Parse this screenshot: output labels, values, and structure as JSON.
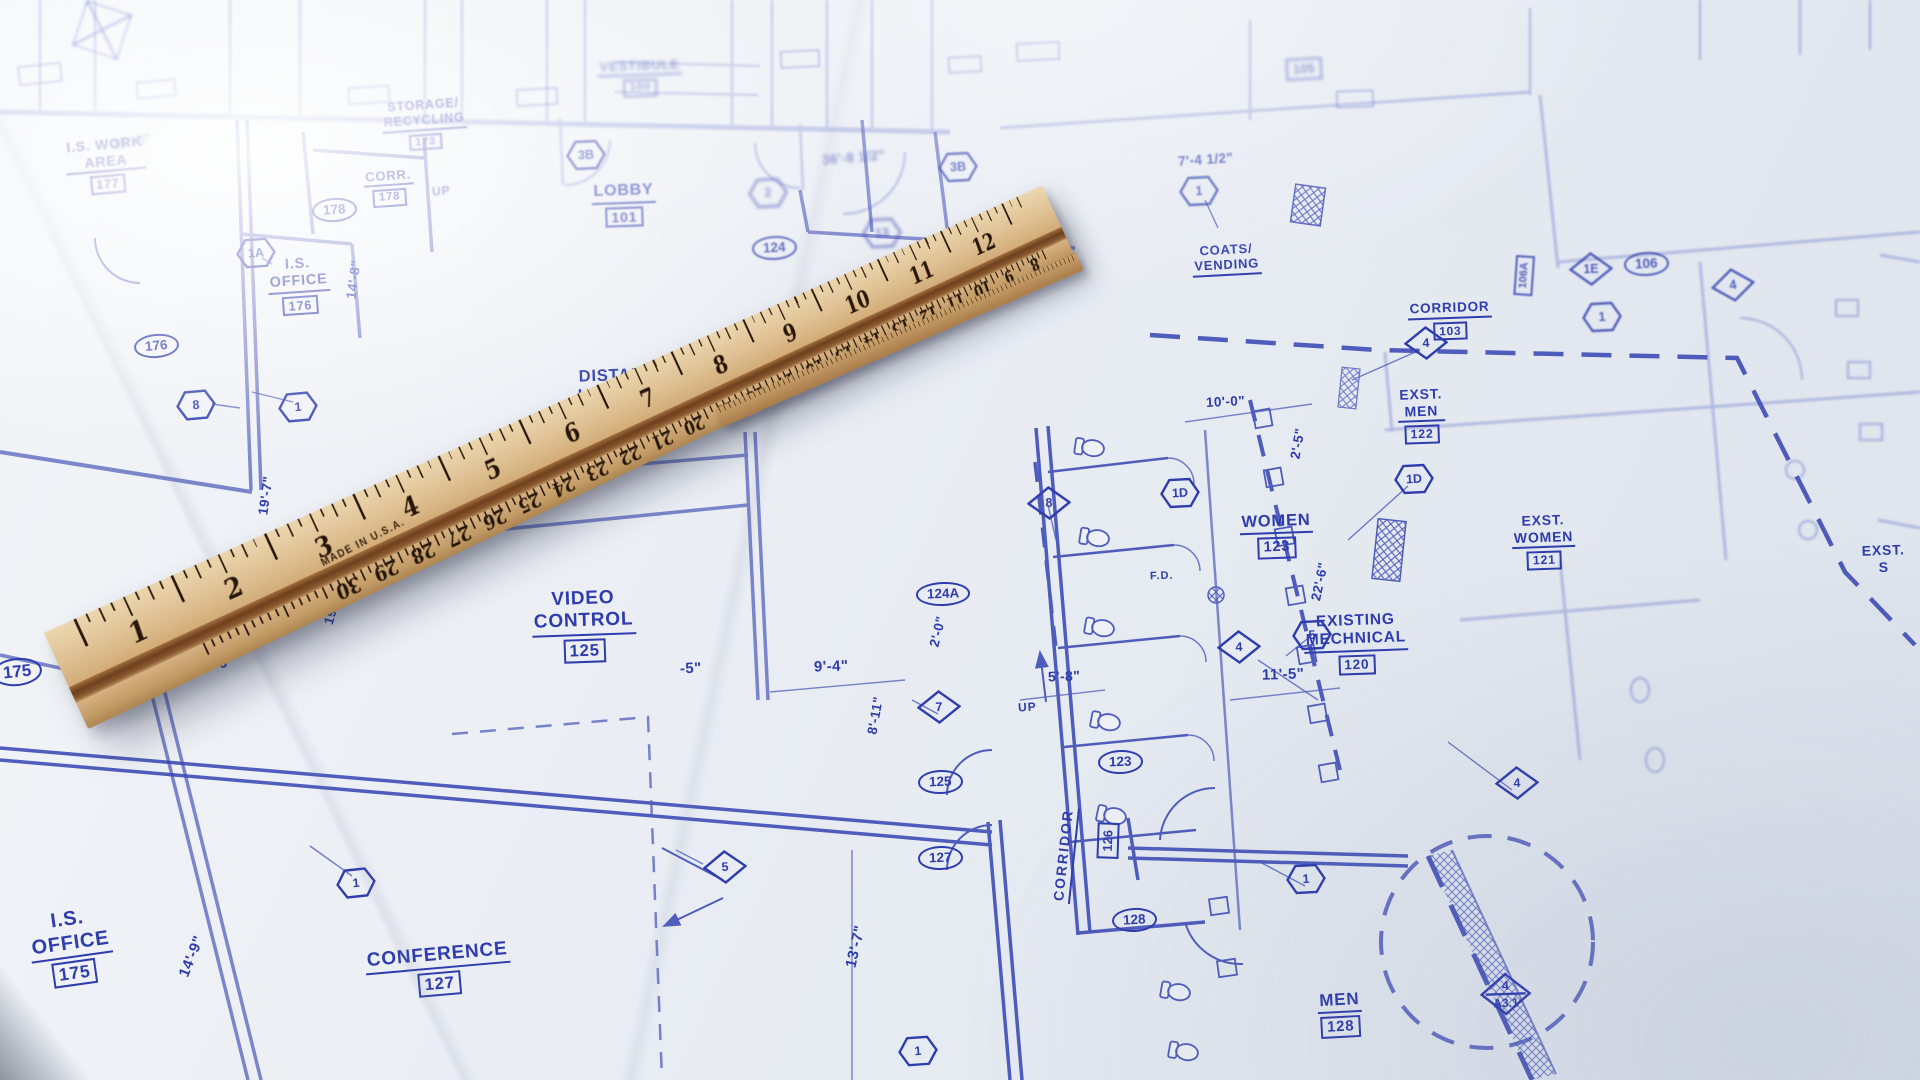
{
  "colors": {
    "ink": "#2e3cae",
    "ink_faint": "#6b78cc",
    "paper": "#e9edf3",
    "wood_light": "#e6cda0",
    "wood_dark": "#ad8551",
    "groove": "#6e3f1d"
  },
  "ruler": {
    "made_in": "MADE IN U.S.A.",
    "inch_numbers": [
      "1",
      "2",
      "3",
      "4",
      "5",
      "6",
      "7",
      "8",
      "9",
      "10",
      "11",
      "12"
    ],
    "cm_numbers": [
      "30",
      "29",
      "28",
      "27",
      "26",
      "25",
      "24",
      "23",
      "22",
      "21",
      "20",
      "19",
      "18",
      "17",
      "16",
      "15",
      "14",
      "13",
      "12",
      "11",
      "10",
      "9",
      "8"
    ]
  },
  "rooms": {
    "work_area": {
      "l1": "I.S. WORK",
      "l2": "AREA",
      "num": "177"
    },
    "storage": {
      "l1": "STORAGE/",
      "l2": "RECYCLING",
      "num": "173"
    },
    "corr": {
      "l1": "CORR.",
      "num": "178"
    },
    "office176": {
      "l1": "I.S.",
      "l2": "OFFICE",
      "num": "176"
    },
    "vestibule": {
      "l1": "VESTIBULE",
      "num": "100"
    },
    "lobby": {
      "l1": "LOBBY",
      "num": "101"
    },
    "distance": {
      "l1": "DISTANCE",
      "l2": "LEARNING",
      "num": "124"
    },
    "video": {
      "l1": "VIDEO",
      "l2": "CONTROL",
      "num": "125"
    },
    "conference": {
      "l1": "CONFERENCE",
      "num": "127"
    },
    "office175": {
      "l1": "I.S.",
      "l2": "OFFICE",
      "num": "175"
    },
    "women": {
      "l1": "WOMEN",
      "num": "123"
    },
    "men": {
      "l1": "MEN",
      "num": "128"
    },
    "corridor126": {
      "l1": "CORRIDOR",
      "num": "126"
    },
    "corridor103": {
      "l1": "CORRIDOR",
      "num": "103"
    },
    "exst_men": {
      "l1": "EXST.",
      "l2": "MEN",
      "num": "122"
    },
    "exst_women": {
      "l1": "EXST.",
      "l2": "WOMEN",
      "num": "121"
    },
    "mechanical": {
      "l1": "EXISTING",
      "l2": "MECHNICAL",
      "num": "120"
    },
    "coats": {
      "l1": "COATS/",
      "l2": "VENDING"
    },
    "exst_s": {
      "l1": "EXST.",
      "l2": "S"
    }
  },
  "dims": {
    "d30_8": "30'-8\"",
    "d36_8": "36'-8 1/2\"",
    "d7_4": "7'-4 1/2\"",
    "d10_0": "10'-0\"",
    "d2_5": "2'-5\"",
    "d22_6": "22'-6\"",
    "d11_5": "11'-5\"",
    "d5_8": "5'-8\"",
    "d2_0": "2'-0\"",
    "d9_4": "9'-4\"",
    "d8_11": "8'-11\"",
    "d13_7": "13'-7\"",
    "d12_6": "12'-6\"",
    "d19_7a": "19'-7\"",
    "d19_7b": "19'-7\"",
    "d14_8": "14'-8\"",
    "d14_9": "14'-9\"",
    "d5p": "-5\""
  },
  "tags": {
    "ovals": [
      "178",
      "176",
      "175",
      "124",
      "124A",
      "125",
      "127",
      "123",
      "128",
      "106"
    ],
    "boxes": [
      "126",
      "106A",
      "105"
    ],
    "hexes": [
      "1A",
      "8",
      "1",
      "3B",
      "3B",
      "2",
      "1",
      "13",
      "1",
      "1",
      "1",
      "5",
      "1D",
      "1D",
      "1"
    ],
    "diamonds": [
      "7",
      "4",
      "4",
      "4",
      "8",
      "1E",
      "4",
      "5"
    ],
    "section": {
      "top": "4",
      "bottom": "A3.1"
    }
  },
  "misc": {
    "fd": "F.D.",
    "up": "UP"
  }
}
